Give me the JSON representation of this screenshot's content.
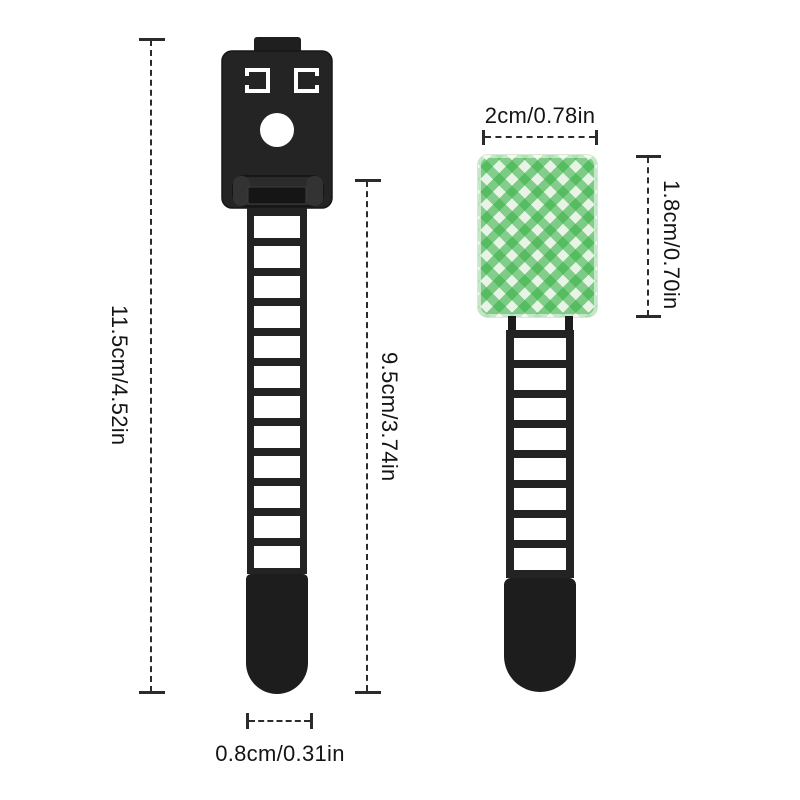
{
  "figure": {
    "background": "#ffffff",
    "plastic_color": "#232323",
    "line_color": "#2b2b2b",
    "text_color": "#141414",
    "pad_green": "#3bb24a",
    "pad_base": "#f6faf2"
  },
  "straps": {
    "left": {
      "window_count": 12
    },
    "right": {
      "window_count": 8
    }
  },
  "dimensions": {
    "left_total": {
      "label": "11.5cm/4.52in",
      "orientation": "vertical"
    },
    "strap_length": {
      "label": "9.5cm/3.74in",
      "orientation": "vertical"
    },
    "strap_width": {
      "label": "0.8cm/0.31in",
      "orientation": "horizontal"
    },
    "pad_width": {
      "label": "2cm/0.78in",
      "orientation": "horizontal"
    },
    "pad_height": {
      "label": "1.8cm/0.70in",
      "orientation": "vertical"
    }
  }
}
